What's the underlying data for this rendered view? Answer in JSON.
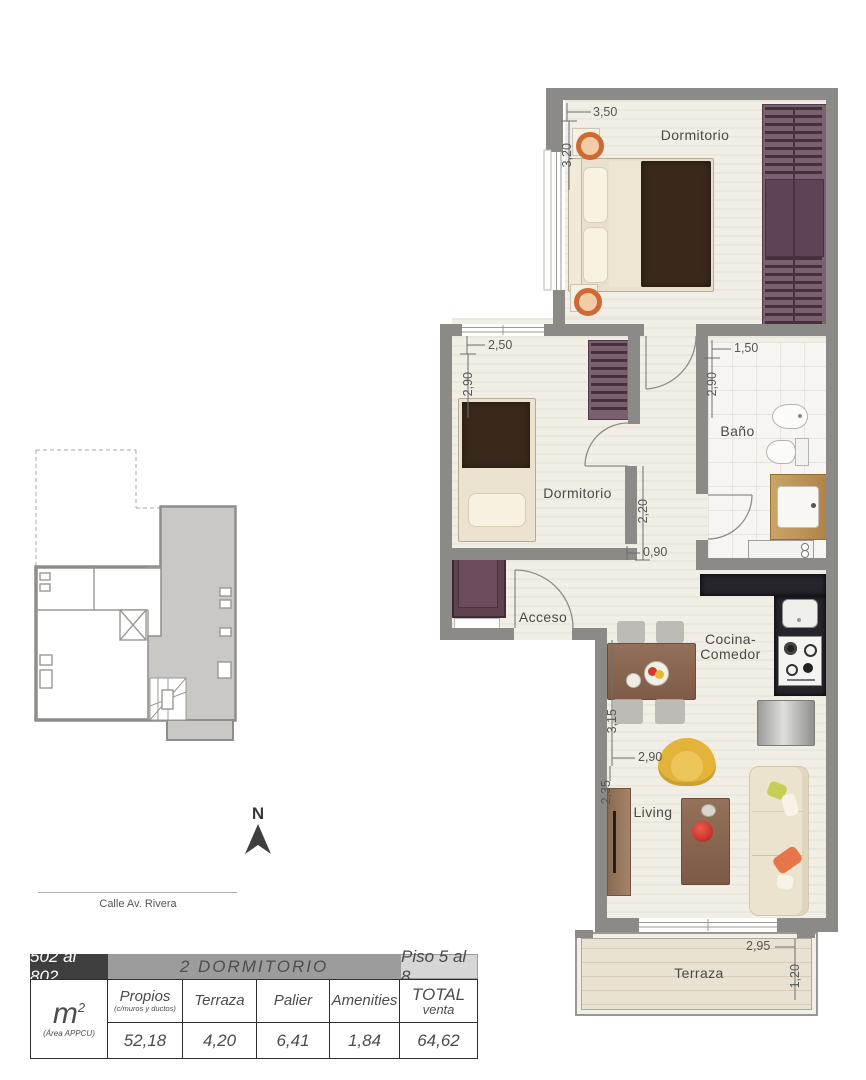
{
  "plan": {
    "rooms": {
      "dormitorio1": "Dormitorio",
      "dormitorio2": "Dormitorio",
      "bano": "Baño",
      "acceso": "Acceso",
      "cocina_line1": "Cocina-",
      "cocina_line2": "Comedor",
      "living": "Living",
      "terraza": "Terraza"
    },
    "dimensions": {
      "dorm1_width": "3,50",
      "dorm1_height": "3,20",
      "dorm2_width": "2,50",
      "dorm2_height": "2,90",
      "bano_width": "1,50",
      "bano_height": "2,90",
      "hall_height": "2,20",
      "hall_width": "0,90",
      "cocina_height": "3,15",
      "living_width": "2,90",
      "living_height": "2,35",
      "terraza_width": "2,95",
      "terraza_height": "1,20"
    }
  },
  "keyplan": {
    "north_label": "N",
    "street_label": "Calle Av. Rivera"
  },
  "summary_table": {
    "unit_range": "502 al 802",
    "unit_type": "2 DORMITORIO",
    "floor_range": "Piso 5 al 8",
    "area_unit": "m",
    "area_unit_sup": "2",
    "area_note": "(Área APPCU)",
    "columns": [
      {
        "label": "Propios",
        "note": "(c/muros y ductos)",
        "value": "52,18"
      },
      {
        "label": "Terraza",
        "note": "",
        "value": "4,20"
      },
      {
        "label": "Palier",
        "note": "",
        "value": "6,41"
      },
      {
        "label": "Amenities",
        "note": "",
        "value": "1,84"
      },
      {
        "label": "TOTAL",
        "note": "venta",
        "value": "64,62"
      }
    ]
  },
  "palette": {
    "wall_gray": "#8c8a86",
    "floor_cream": "#f1eee6",
    "wardrobe_purple": "#7b6070",
    "counter_dark": "#26252b",
    "accent_yellow": "#e3b33a",
    "accent_red": "#c7332b",
    "accent_orange": "#d4713c",
    "header_dark": "#3f3f3f",
    "header_mid": "#9c9c9c",
    "header_light": "#d6d6d6"
  }
}
